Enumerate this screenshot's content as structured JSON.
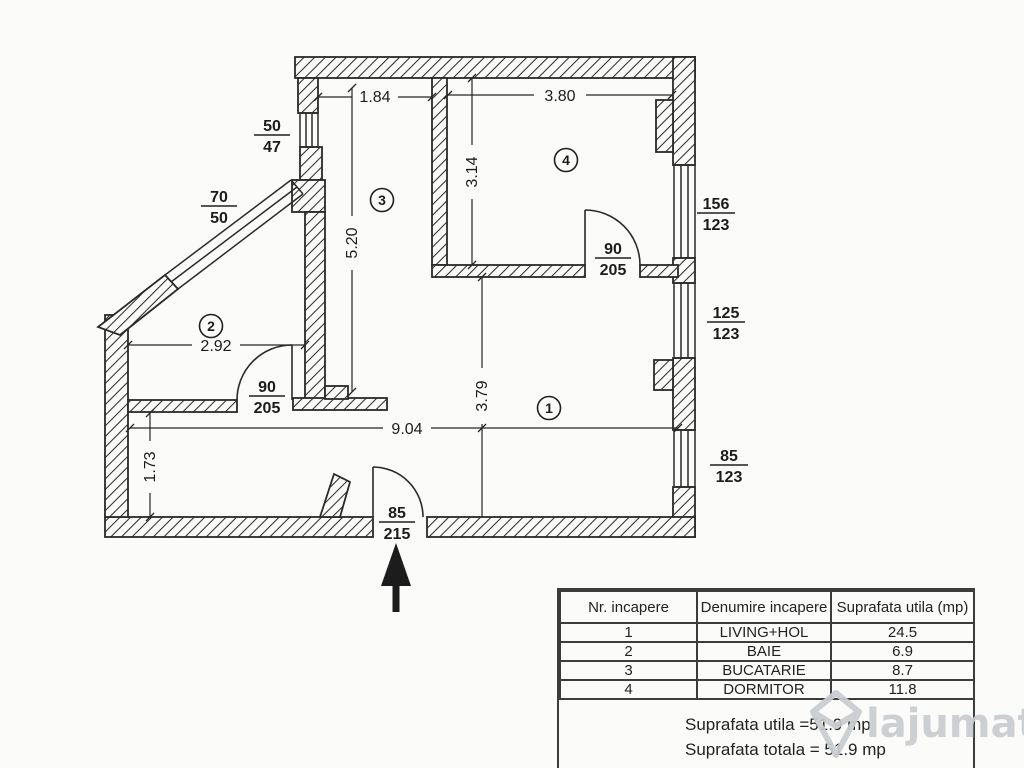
{
  "colors": {
    "ink": "#2a2a2a",
    "paper": "#fbfbfa",
    "watermark": "#c9cdcf",
    "watermark_ro": "#aeb5b1"
  },
  "plan": {
    "rooms": [
      {
        "num": "1"
      },
      {
        "num": "2"
      },
      {
        "num": "3"
      },
      {
        "num": "4"
      }
    ],
    "dims": {
      "kitchen_w": "1.84",
      "bedroom_w": "3.80",
      "bedroom_h": "3.14",
      "kitchen_h": "5.20",
      "living_h": "3.79",
      "bath_w": "2.92",
      "living_w": "9.04",
      "hall_h": "1.73"
    },
    "openings": {
      "win_left": {
        "a": "50",
        "b": "47"
      },
      "win_diag": {
        "a": "70",
        "b": "50"
      },
      "win_right_top": {
        "a": "156",
        "b": "123"
      },
      "win_right_mid": {
        "a": "125",
        "b": "123"
      },
      "win_right_bot": {
        "a": "85",
        "b": "123"
      },
      "door_bedroom": {
        "a": "90",
        "b": "205"
      },
      "door_bath": {
        "a": "90",
        "b": "205"
      },
      "door_entry": {
        "a": "85",
        "b": "215"
      }
    }
  },
  "table": {
    "headers": [
      "Nr. incapere",
      "Denumire incapere",
      "Suprafata utila (mp)"
    ],
    "rows": [
      {
        "nr": "1",
        "name": "LIVING+HOL",
        "mp": "24.5"
      },
      {
        "nr": "2",
        "name": "BAIE",
        "mp": "6.9"
      },
      {
        "nr": "3",
        "name": "BUCATARIE",
        "mp": "8.7"
      },
      {
        "nr": "4",
        "name": "DORMITOR",
        "mp": "11.8"
      }
    ]
  },
  "totals": {
    "line1": "Suprafata utila =51.9 mp",
    "line2": "Suprafata totala = 51.9 mp"
  },
  "watermark": {
    "brand": "lajumate",
    "tld": ".ro"
  }
}
